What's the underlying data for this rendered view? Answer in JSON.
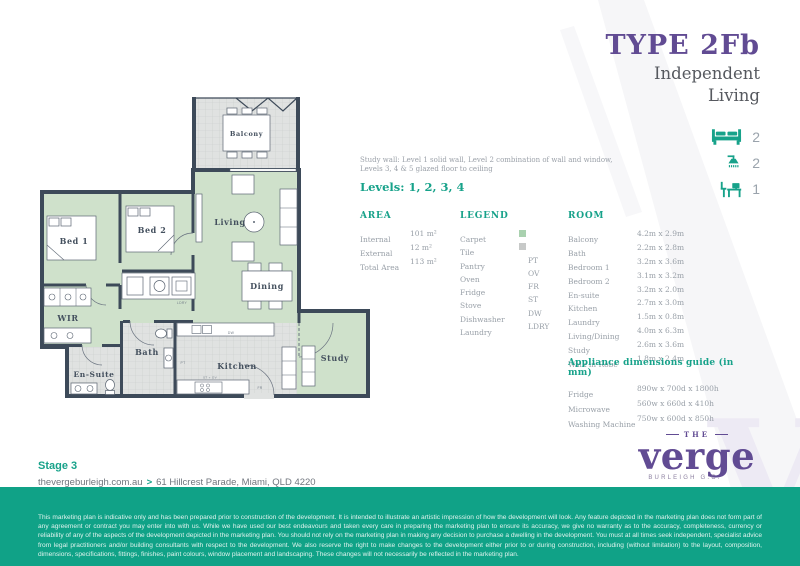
{
  "header": {
    "title": "TYPE 2Fb",
    "subtitle1": "Independent",
    "subtitle2": "Living"
  },
  "features": [
    {
      "icon": "bed-icon",
      "label": "bedrooms",
      "count": "2"
    },
    {
      "icon": "shower-icon",
      "label": "bathrooms",
      "count": "2"
    },
    {
      "icon": "study-desk-icon",
      "label": "study",
      "count": "1"
    }
  ],
  "note": {
    "line1": "Study wall: Level 1 solid wall, Level 2 combination of wall and window,",
    "line2": "Levels 3, 4 & 5 glazed floor to ceiling"
  },
  "levels_label": "Levels: 1, 2, 3, 4",
  "area": {
    "title": "AREA",
    "rows": [
      {
        "label": "Internal",
        "value": "101 m²"
      },
      {
        "label": "External",
        "value": "12 m²"
      },
      {
        "label": "Total Area",
        "value": "113 m²"
      }
    ]
  },
  "legend": {
    "title": "LEGEND",
    "rows": [
      {
        "label": "Carpet",
        "code": ""
      },
      {
        "label": "Tile",
        "code": ""
      },
      {
        "label": "Pantry",
        "code": "PT"
      },
      {
        "label": "Oven",
        "code": "OV"
      },
      {
        "label": "Fridge",
        "code": "FR"
      },
      {
        "label": "Stove",
        "code": "ST"
      },
      {
        "label": "Dishwasher",
        "code": "DW"
      },
      {
        "label": "Laundry",
        "code": "LDRY"
      }
    ]
  },
  "rooms": {
    "title": "ROOM",
    "rows": [
      {
        "name": "Balcony",
        "dim": "4.2m x 2.9m"
      },
      {
        "name": "Bath",
        "dim": "2.2m x 2.8m"
      },
      {
        "name": "Bedroom 1",
        "dim": "3.2m x 3.6m"
      },
      {
        "name": "Bedroom 2",
        "dim": "3.1m x 3.2m"
      },
      {
        "name": "En-suite",
        "dim": "3.2m x 2.0m"
      },
      {
        "name": "Kitchen",
        "dim": "2.7m x 3.0m"
      },
      {
        "name": "Laundry",
        "dim": "1.5m x 0.8m"
      },
      {
        "name": "Living/Dining",
        "dim": "4.0m x 6.3m"
      },
      {
        "name": "Study",
        "dim": "2.6m x 3.6m"
      },
      {
        "name": "Walk in Robe",
        "dim": "1.8m x 2.4m"
      }
    ]
  },
  "appliances": {
    "title": "Appliance dimensions guide (in mm)",
    "rows": [
      {
        "name": "Fridge",
        "dim": "890w x 700d x 1800h"
      },
      {
        "name": "Microwave",
        "dim": "560w x 660d x 410h"
      },
      {
        "name": "Washing Machine",
        "dim": "750w x 600d x 850h"
      }
    ]
  },
  "floorplan": {
    "balcony": "Balcony",
    "living": "Living",
    "dining": "Dining",
    "bed1": "Bed 1",
    "bed2": "Bed 2",
    "wir": "WIR",
    "bath": "Bath",
    "ensuite": "En-Suite",
    "kitchen": "Kitchen",
    "study": "Study",
    "ldry": "LDRY",
    "dw": "DW",
    "pt": "PT",
    "fr": "FR",
    "st_ov": "ST + OV"
  },
  "footer_info": {
    "stage": "Stage 3",
    "website": "thevergeburleigh.com.au",
    "separator": ">",
    "address": "61 Hillcrest Parade, Miami, QLD 4220"
  },
  "logo": {
    "the": "THE",
    "name": "verge",
    "location": "BURLEIGH G.C."
  },
  "disclaimer": "This marketing plan is indicative only and has been prepared prior to construction of the development. It is intended to illustrate an artistic impression of how the development will look. Any feature depicted in the marketing plan does not form part of any agreement or contract you may enter into with us. While we have used our best endeavours and taken every care in preparing the marketing plan to ensure its accuracy, we give no warranty as to the accuracy, completeness, currency or reliability of any of the aspects of the development depicted in the marketing plan. You should not rely on the marketing plan in making any decision to purchase a dwelling in the development. You must at all times seek independent, specialist advice from legal practitioners and/or building consultants with respect to the development. We also reserve the right to make changes to the development either prior to or during construction, including (without limitation) to the layout, composition, dimensions, specifications, fittings, finishes, paint colours, window placement and landscaping. These changes will not necessarily be reflected in the marketing plan.",
  "colors": {
    "teal": "#17A28A",
    "purple": "#614B93",
    "footer_teal": "#10A287",
    "carpet": "#CFE1CB",
    "tile": "#E0E2E1",
    "wall": "#3D4A59",
    "carpet_swatch": "#A9D1AF",
    "tile_swatch": "#C7C9C8"
  }
}
